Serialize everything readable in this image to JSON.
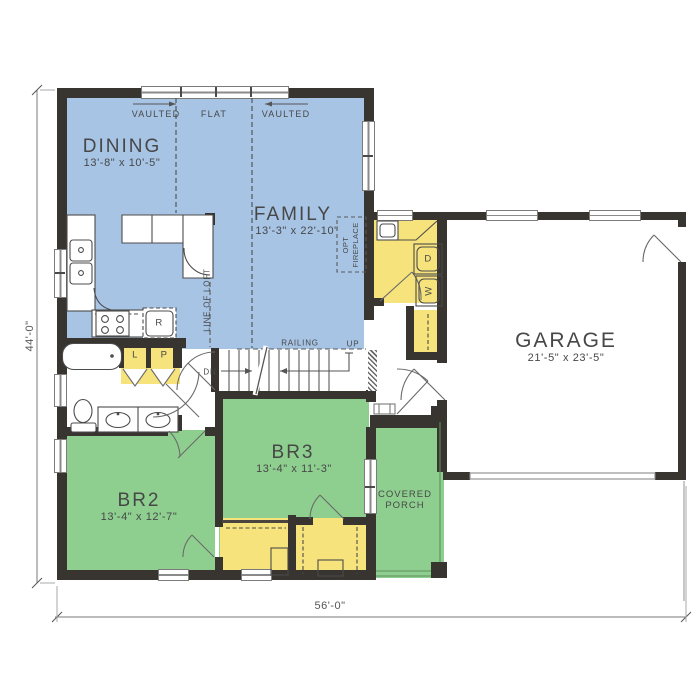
{
  "rooms": {
    "dining": {
      "name": "DINING",
      "dims": "13'-8\" x 10'-5\""
    },
    "family": {
      "name": "FAMILY",
      "dims": "13'-3\" x 22'-10\""
    },
    "garage": {
      "name": "GARAGE",
      "dims": "21'-5\" x 23'-5\""
    },
    "br2": {
      "name": "BR2",
      "dims": "13'-4\" x 12'-7\""
    },
    "br3": {
      "name": "BR3",
      "dims": "13'-4\" x 11'-3\""
    },
    "porch": {
      "line1": "COVERED",
      "line2": "PORCH"
    }
  },
  "ceiling": {
    "vaulted_left": "VAULTED",
    "flat": "FLAT",
    "vaulted_right": "VAULTED"
  },
  "stairs": {
    "railing": "RAILING",
    "up": "UP",
    "dn": "DN"
  },
  "annotations": {
    "line_of_loft": "LINE OF LOFT",
    "opt_fireplace_top": "OPT",
    "opt_fireplace_bottom": "FIREPLACE"
  },
  "fixtures": {
    "refrigerator": "R",
    "linen": "L",
    "pantry": "P",
    "dryer": "D",
    "washer": "W"
  },
  "dimensions": {
    "width": "56'-0\"",
    "height": "44'-0\""
  },
  "colors": {
    "living": "#a7c4e5",
    "bedroom": "#8ecf90",
    "storage": "#f6e37b",
    "wall": "#38342f"
  }
}
